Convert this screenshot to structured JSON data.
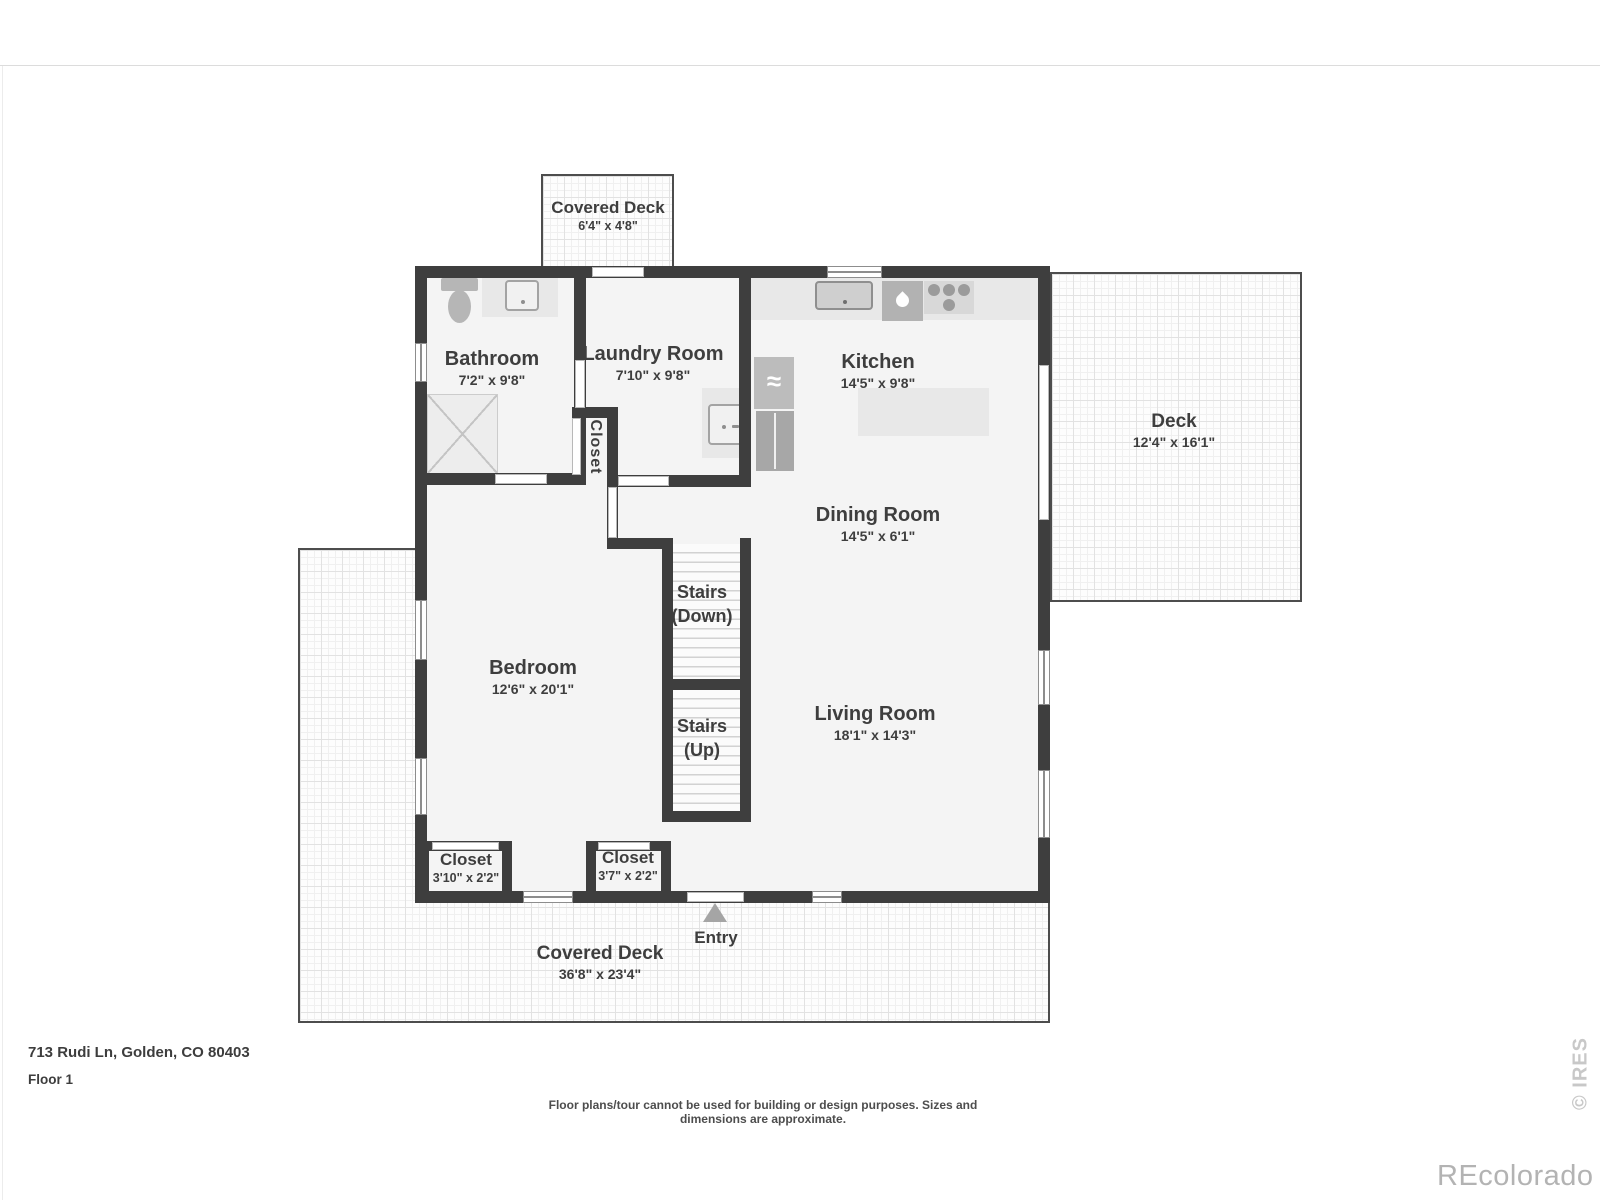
{
  "plan": {
    "address": "713 Rudi Ln, Golden, CO 80403",
    "floor_label": "Floor 1",
    "disclaimer": "Floor plans/tour cannot be used for building or design purposes. Sizes and dimensions are approximate.",
    "watermark": "REcolorado",
    "copyright": "© IRES",
    "icons": {
      "water_heater_glyph": "≈"
    },
    "colors": {
      "wall": "#3e3e3e",
      "floor": "#f4f4f4",
      "counter": "#e8e8e8",
      "appliance": "#b0b0b0",
      "label_text": "#3e3e3e",
      "watermark_gray": "#b3b3b3"
    },
    "rooms": [
      {
        "id": "covered-deck-top",
        "name": "Covered Deck",
        "dims": "6'4\" x 4'8\""
      },
      {
        "id": "bathroom",
        "name": "Bathroom",
        "dims": "7'2\" x 9'8\""
      },
      {
        "id": "laundry-room",
        "name": "Laundry Room",
        "dims": "7'10\" x 9'8\""
      },
      {
        "id": "kitchen",
        "name": "Kitchen",
        "dims": "14'5\" x 9'8\""
      },
      {
        "id": "deck",
        "name": "Deck",
        "dims": "12'4\" x 16'1\""
      },
      {
        "id": "dining-room",
        "name": "Dining Room",
        "dims": "14'5\" x 6'1\""
      },
      {
        "id": "stairs-down",
        "name": "Stairs",
        "dims": "(Down)"
      },
      {
        "id": "stairs-up",
        "name": "Stairs",
        "dims": "(Up)"
      },
      {
        "id": "bedroom",
        "name": "Bedroom",
        "dims": "12'6\" x 20'1\""
      },
      {
        "id": "living-room",
        "name": "Living Room",
        "dims": "18'1\" x 14'3\""
      },
      {
        "id": "closet-hall",
        "name": "Closet",
        "dims": ""
      },
      {
        "id": "closet-bedroom-left",
        "name": "Closet",
        "dims": "3'10\" x 2'2\""
      },
      {
        "id": "closet-bedroom-right",
        "name": "Closet",
        "dims": "3'7\" x 2'2\""
      },
      {
        "id": "entry",
        "name": "Entry",
        "dims": ""
      },
      {
        "id": "covered-deck-bottom",
        "name": "Covered Deck",
        "dims": "36'8\" x 23'4\""
      }
    ]
  }
}
